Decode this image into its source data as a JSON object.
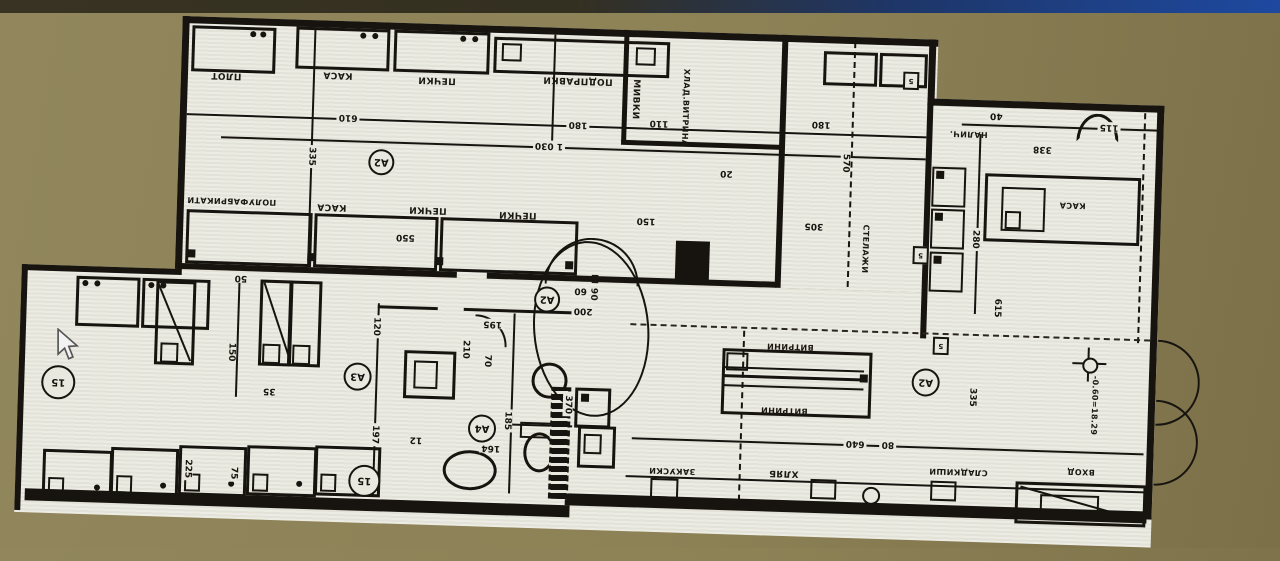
{
  "scene": {
    "description": "Photographed monitor showing an upside-down architectural floor plan (coffee/bakery shop fit-out)",
    "background_color": "#8d8156",
    "top_bar_color": "#1e49a0",
    "paper_color": "#e9e8df",
    "ink_color": "#17140f"
  },
  "labels": {
    "plot": "ПЛОТ",
    "kasa1": "КАСА",
    "pechki1": "ПЕЧКИ",
    "podpravki": "ПОДПРАВКИ",
    "polufabrikati": "ПОЛУФАБРИКАТИ",
    "kasa2": "КАСА",
    "pechki2": "ПЕЧКИ",
    "pechki3": "ПЕЧКИ",
    "mivki": "МИВКИ",
    "hlad": "ХЛАД.ВИТРИНА",
    "stelaji": "СТЕЛАЖИ",
    "nalich": "НАЛИЧ.",
    "kasa3": "КАСА",
    "vitrini": "ВИТРИНИ",
    "zakuski": "ЗАКУСКИ",
    "hlyab": "ХЛЯБ",
    "sladkishi": "СЛАДКИШИ",
    "vhod": "ВХОД",
    "ei90": "EI 90",
    "elevation": "-0.60=18.29"
  },
  "markers": {
    "a2": "А2",
    "a3": "А3",
    "a4": "А4",
    "m15": "15",
    "t5": "5"
  },
  "dims": {
    "d610": "610",
    "d180": "180",
    "d1030": "1 030",
    "d335": "335",
    "d550": "550",
    "d110": "110",
    "d570": "570",
    "d150": "150",
    "d305": "305",
    "d20": "20",
    "d40": "40",
    "d115": "115",
    "d338": "338",
    "d280": "280",
    "d615": "615",
    "d50": "50",
    "d35": "35",
    "d225": "225",
    "d75": "75",
    "d197": "197",
    "d12": "12",
    "d120": "120",
    "d195": "195",
    "d210": "210",
    "d70": "70",
    "d185": "185",
    "d164": "164",
    "d200": "200",
    "d60": "60",
    "d370": "370",
    "d640": "640",
    "d80": "80"
  }
}
